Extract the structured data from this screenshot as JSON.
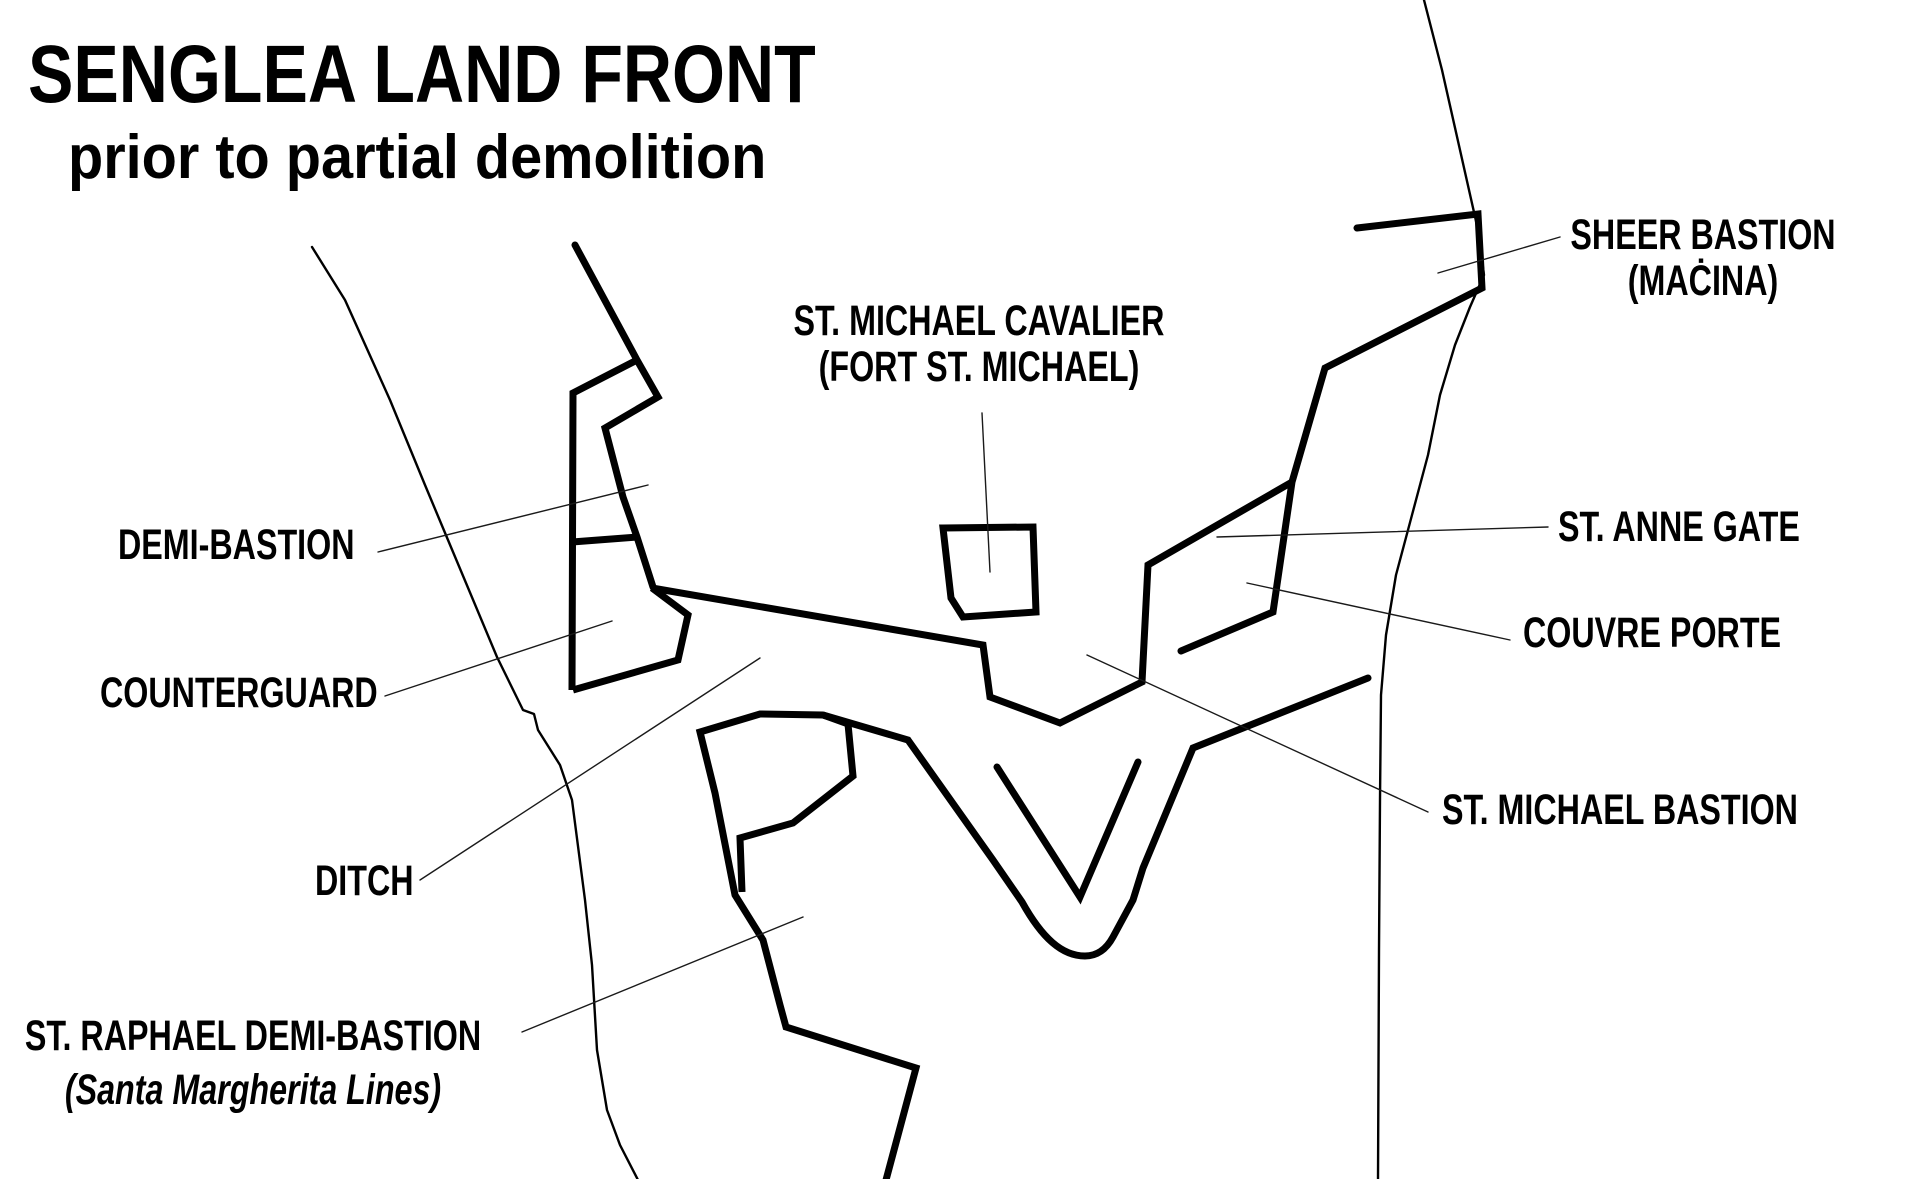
{
  "colors": {
    "background": "#ffffff",
    "ink": "#000000",
    "leader_line": "#1a1a1a"
  },
  "title": {
    "text": "SENGLEA LAND FRONT",
    "subtitle": "prior to partial demolition"
  },
  "labels": {
    "sheer_bastion": {
      "line1": "SHEER BASTION",
      "line2": "(MAĊINA)"
    },
    "st_michael_cavalier": {
      "line1": "ST. MICHAEL CAVALIER",
      "line2": "(FORT ST. MICHAEL)"
    },
    "st_anne_gate": {
      "text": "ST. ANNE GATE"
    },
    "couvre_porte": {
      "text": "COUVRE PORTE"
    },
    "st_michael_bastion": {
      "text": "ST. MICHAEL BASTION"
    },
    "demi_bastion": {
      "text": "DEMI-BASTION"
    },
    "counterguard": {
      "text": "COUNTERGUARD"
    },
    "ditch": {
      "text": "DITCH"
    },
    "st_raphael_demi_bastion": {
      "line1": "ST. RAPHAEL DEMI-BASTION",
      "line2": "(Santa Margherita Lines)"
    }
  }
}
